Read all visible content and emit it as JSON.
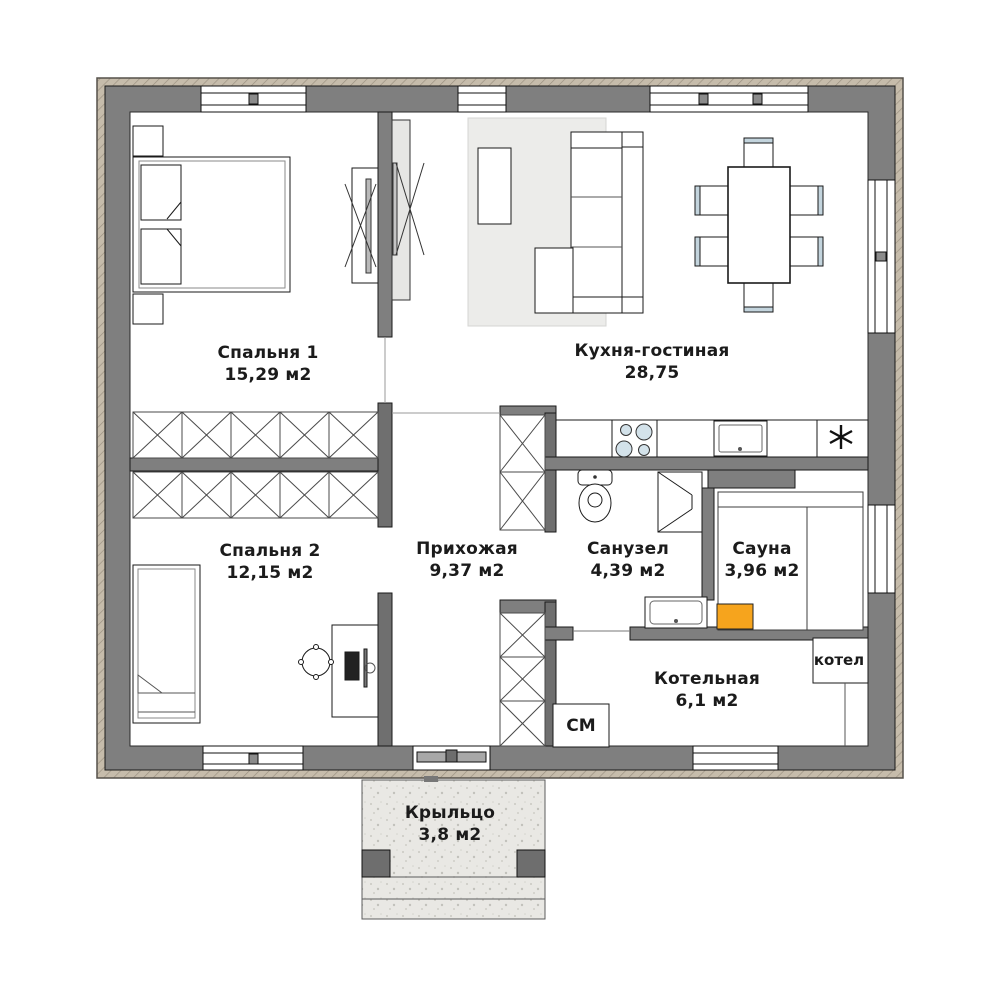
{
  "plan_title": "one-storey house floor plan",
  "rooms": [
    {
      "id": "bedroom1",
      "name": "Спальня 1",
      "area": "15,29 м2"
    },
    {
      "id": "kitchen_living",
      "name": "Кухня-гостиная",
      "area": "28,75"
    },
    {
      "id": "bedroom2",
      "name": "Спальня 2",
      "area": "12,15 м2"
    },
    {
      "id": "hallway",
      "name": "Прихожая",
      "area": "9,37 м2"
    },
    {
      "id": "bathroom",
      "name": "Санузел",
      "area": "4,39 м2"
    },
    {
      "id": "sauna",
      "name": "Сауна",
      "area": "3,96 м2"
    },
    {
      "id": "boiler_room",
      "name": "Котельная",
      "area": "6,1 м2"
    },
    {
      "id": "porch",
      "name": "Крыльцо",
      "area": "3,8 м2"
    }
  ],
  "appliances": [
    {
      "id": "washing_machine",
      "label": "СМ"
    },
    {
      "id": "boiler_unit",
      "label": "котел"
    }
  ],
  "colors": {
    "wall": "#7f7f7f",
    "wall_dark": "#6f6f6f",
    "facade_hatch": "#c6bcab",
    "floor": "#ffffff",
    "rug": "#ececea",
    "porch_concrete": "#e9e8e4",
    "sauna_heater": "#f6a41d",
    "chair_accent": "#c3d4dd",
    "burner_fill": "#d3e2ea",
    "text": "#1b1b1b"
  }
}
